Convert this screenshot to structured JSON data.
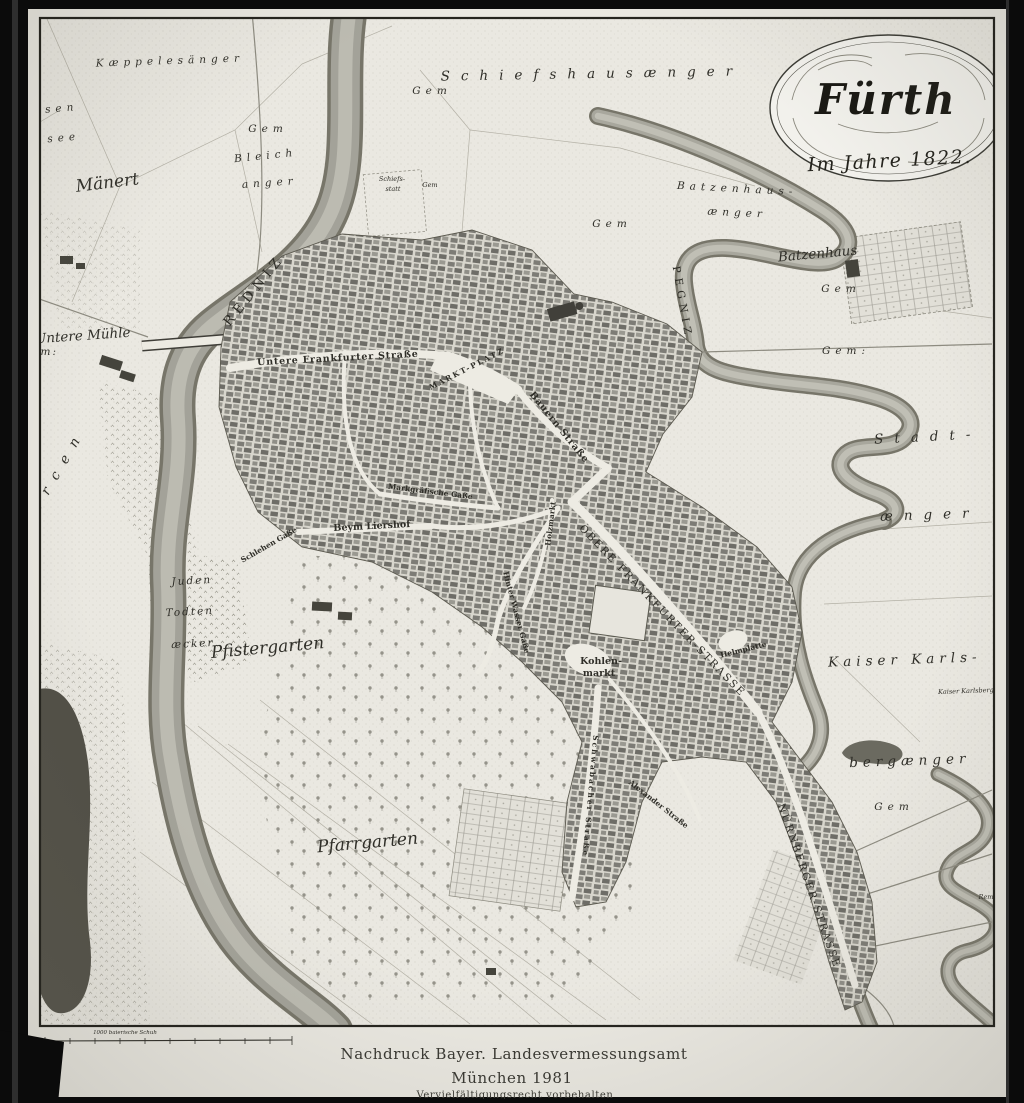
{
  "cartouche": {
    "title": "Fürth",
    "subtitle": "Im Jahre 1822."
  },
  "imprint": {
    "line1": "Nachdruck  Bayer. Landesvermessungsamt",
    "line2": "München 1981",
    "line3": "Vervielfältigungsrecht vorbehalten"
  },
  "scale_bar": {
    "label": "1000 baierische Schuh"
  },
  "colors": {
    "paper": "#eae8e1",
    "ink": "#2f2e28",
    "river": "#a3a299",
    "frame": "#0b0b0b"
  },
  "map_labels": [
    {
      "id": "kaeppelesaenger",
      "text": "Kæppelesänger"
    },
    {
      "id": "bimsen",
      "text": "Bimsen"
    },
    {
      "id": "bimsen_see",
      "text": "see"
    },
    {
      "id": "maenert",
      "text": "Mänert"
    },
    {
      "id": "gem_bleich",
      "text": "Gem"
    },
    {
      "id": "bleich",
      "text": "Bleich"
    },
    {
      "id": "bleich_anger",
      "text": "anger"
    },
    {
      "id": "schiefshausaenger",
      "text": "Schiefshausænger"
    },
    {
      "id": "gem_schiefshaus",
      "text": "Gem"
    },
    {
      "id": "schiefsstatt1",
      "text": "Schiefs-"
    },
    {
      "id": "schiefsstatt2",
      "text": "statt"
    },
    {
      "id": "gem_schiefsstatt",
      "text": "Gem"
    },
    {
      "id": "gem_pegnitz_top",
      "text": "Gem"
    },
    {
      "id": "batzenhausaenger1",
      "text": "Batzenhaus-"
    },
    {
      "id": "batzenhausaenger2",
      "text": "ænger"
    },
    {
      "id": "batzenhaus",
      "text": "Batzenhaus"
    },
    {
      "id": "gem_batzenhaus",
      "text": "Gem"
    },
    {
      "id": "gem_right",
      "text": "Gem:"
    },
    {
      "id": "stadt",
      "text": "Stadt-"
    },
    {
      "id": "stadt_aenger",
      "text": "ænger"
    },
    {
      "id": "untere_muehle",
      "text": "Untere Mühle"
    },
    {
      "id": "gem_muehle",
      "text": "Gem:"
    },
    {
      "id": "redniz",
      "text": "REDNIZ"
    },
    {
      "id": "pegniz",
      "text": "PEGNIZ"
    },
    {
      "id": "untere_frankfurter",
      "text": "Untere Frankfurter Straße"
    },
    {
      "id": "marktplatz",
      "text": "MARKT-PLATZ"
    },
    {
      "id": "bauern_strasse",
      "text": "Bauern Straße"
    },
    {
      "id": "markgraefische",
      "text": "Markgräfische Gaße"
    },
    {
      "id": "beym_liershof",
      "text": "Beym Liershof"
    },
    {
      "id": "schlehen",
      "text": "Schlehen Gaße"
    },
    {
      "id": "juden1",
      "text": "Juden"
    },
    {
      "id": "juden2",
      "text": "Todten"
    },
    {
      "id": "juden3",
      "text": "æcker"
    },
    {
      "id": "pfistergarten",
      "text": "Pfistergarten"
    },
    {
      "id": "holzmarkt",
      "text": "Holzmarkt"
    },
    {
      "id": "hinter_wasser",
      "text": "Hinter Wasser Gaße"
    },
    {
      "id": "obere_frankfurter",
      "text": "OBERE FRANKFURTER-STRASSE"
    },
    {
      "id": "kohlenmarkt1",
      "text": "Kohlen-"
    },
    {
      "id": "kohlenmarkt2",
      "text": "markt"
    },
    {
      "id": "helmplatte",
      "text": "Helmplatte"
    },
    {
      "id": "schwabacher",
      "text": "Schwabacher Straße"
    },
    {
      "id": "alexander",
      "text": "Alexander Straße"
    },
    {
      "id": "pfarrgarten",
      "text": "Pfarrgarten"
    },
    {
      "id": "kaiser_karls",
      "text": "Kaiser Karls-"
    },
    {
      "id": "bergaenger",
      "text": "bergænger"
    },
    {
      "id": "gem_kaiser",
      "text": "Gem"
    },
    {
      "id": "karlsberg",
      "text": "Kaiser Karlsberg"
    },
    {
      "id": "nuernberger",
      "text": "NÜRNBERGER-STRASSE"
    },
    {
      "id": "rem",
      "text": "Rem"
    },
    {
      "id": "bercen",
      "text": "Bercen"
    },
    {
      "id": "gem_left",
      "text": "Gem"
    }
  ]
}
